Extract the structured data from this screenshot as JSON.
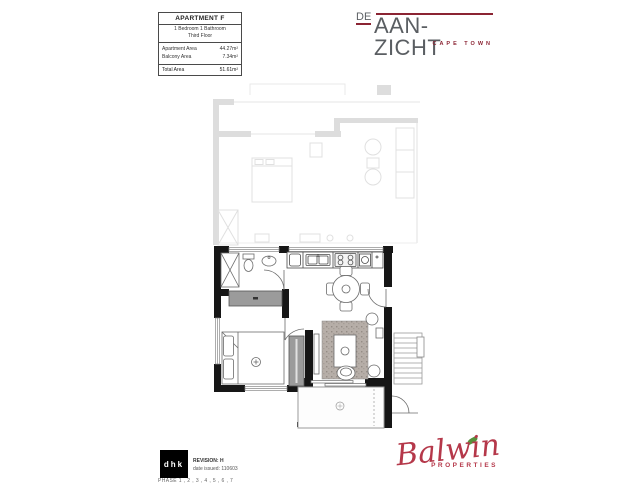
{
  "info_table": {
    "title": "APARTMENT F",
    "subtitle_line1": "1 Bedroom 1 Bathroom",
    "subtitle_line2": "Third Floor",
    "rows": [
      {
        "label": "Apartment Area",
        "value": "44.27m²"
      },
      {
        "label": "Balcony Area",
        "value": "7.34m²"
      }
    ],
    "total": {
      "label": "Total Area",
      "value": "51.61m²"
    }
  },
  "development_logo": {
    "prefix": "DE",
    "name": "AAN-ZICHT",
    "city": "CAPE TOWN",
    "accent_color": "#8b2433",
    "text_color": "#5a5e62"
  },
  "architect_block": {
    "logo": "dhk",
    "revision": "REVISION: H",
    "date_issued": "date issued: 110603",
    "phase": "PHASE 1 , 2 , 3 , 4 , 5 , 6 , 7"
  },
  "developer_logo": {
    "name": "Balwin",
    "word": "PROPERTIES",
    "script_color": "#b5384a",
    "leaf_color": "#57903c"
  },
  "floor_plan_colors": {
    "wall": "#161616",
    "faded_upper_floor": "#c2c2c2",
    "furniture": "#6b6b6b",
    "cabinet": "#9b9b9b",
    "rug": "#b6aea8"
  }
}
